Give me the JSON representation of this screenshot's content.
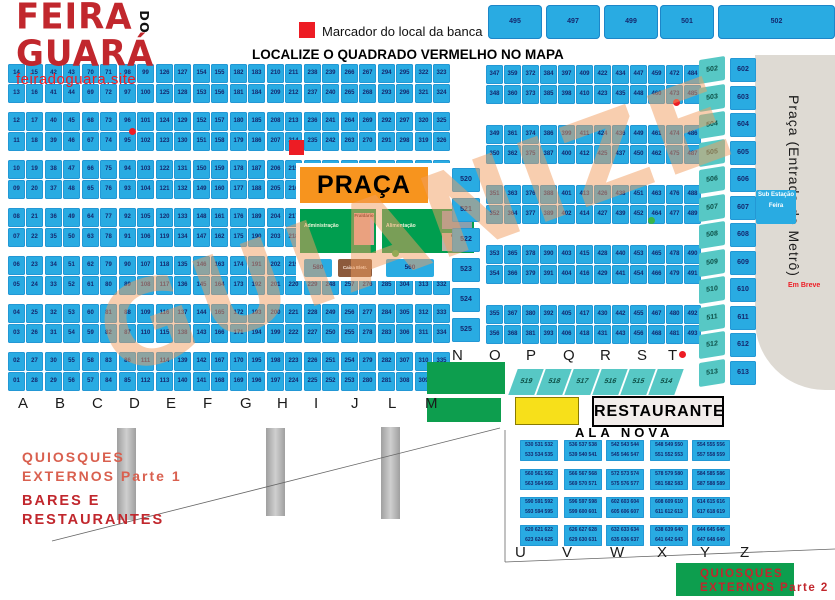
{
  "logo": {
    "line1": "FEIRA",
    "do_text": "DO",
    "line2": "GUARÁ",
    "site": "feiradoguara.site"
  },
  "legend": {
    "marker_label": "Marcador do local da banca",
    "title": "LOCALIZE O QUADRADO VERMELHO NO MAPA"
  },
  "watermark": "GUIANIZE",
  "colors": {
    "stall_blue": "#29ABE2",
    "teal": "#57C8C5",
    "accent_red": "#ED1C24",
    "dark_red": "#C1272D",
    "orange": "#F7941E",
    "green": "#0D9E4E",
    "yellow": "#F7E01A",
    "gray_shape": "#DEDAD3"
  },
  "top_blocks": {
    "squares": [
      495,
      497,
      499,
      501
    ],
    "wide": 502
  },
  "main_grid": {
    "columns": [
      {
        "letter": "A",
        "pairs": [
          [
            14,
            15
          ],
          [
            13,
            16
          ],
          [
            12,
            17
          ],
          [
            11,
            18
          ],
          [
            10,
            19
          ],
          [
            9,
            20
          ],
          [
            8,
            21
          ],
          [
            7,
            22
          ],
          [
            6,
            23
          ],
          [
            5,
            24
          ],
          [
            4,
            25
          ],
          [
            3,
            26
          ],
          [
            2,
            27
          ],
          [
            1,
            28
          ]
        ]
      },
      {
        "letter": "B",
        "pairs": [
          [
            42,
            43
          ],
          [
            41,
            44
          ],
          [
            40,
            45
          ],
          [
            39,
            46
          ],
          [
            38,
            47
          ],
          [
            37,
            48
          ],
          [
            36,
            49
          ],
          [
            35,
            50
          ],
          [
            34,
            51
          ],
          [
            33,
            52
          ],
          [
            32,
            53
          ],
          [
            31,
            54
          ],
          [
            30,
            55
          ],
          [
            29,
            56
          ]
        ]
      },
      {
        "letter": "C",
        "pairs": [
          [
            70,
            71
          ],
          [
            69,
            72
          ],
          [
            68,
            73
          ],
          [
            67,
            74
          ],
          [
            66,
            75
          ],
          [
            65,
            76
          ],
          [
            64,
            77
          ],
          [
            63,
            78
          ],
          [
            62,
            79
          ],
          [
            61,
            80
          ],
          [
            60,
            81
          ],
          [
            59,
            82
          ],
          [
            58,
            83
          ],
          [
            57,
            84
          ]
        ]
      },
      {
        "letter": "D",
        "pairs": [
          [
            98,
            99
          ],
          [
            97,
            100
          ],
          [
            96,
            101
          ],
          [
            95,
            102
          ],
          [
            94,
            103
          ],
          [
            93,
            104
          ],
          [
            92,
            105
          ],
          [
            91,
            106
          ],
          [
            90,
            107
          ],
          [
            89,
            108
          ],
          [
            88,
            109
          ],
          [
            87,
            110
          ],
          [
            86,
            111
          ],
          [
            85,
            112
          ]
        ]
      },
      {
        "letter": "E",
        "pairs": [
          [
            126,
            127
          ],
          [
            125,
            128
          ],
          [
            124,
            129
          ],
          [
            123,
            130
          ],
          [
            122,
            131
          ],
          [
            121,
            132
          ],
          [
            120,
            133
          ],
          [
            119,
            134
          ],
          [
            118,
            135
          ],
          [
            117,
            136
          ],
          [
            116,
            137
          ],
          [
            115,
            138
          ],
          [
            114,
            139
          ],
          [
            113,
            140
          ]
        ]
      },
      {
        "letter": "F",
        "pairs": [
          [
            154,
            155
          ],
          [
            153,
            156
          ],
          [
            152,
            157
          ],
          [
            151,
            158
          ],
          [
            150,
            159
          ],
          [
            149,
            160
          ],
          [
            148,
            161
          ],
          [
            147,
            162
          ],
          [
            146,
            163
          ],
          [
            145,
            164
          ],
          [
            144,
            165
          ],
          [
            143,
            166
          ],
          [
            142,
            167
          ],
          [
            141,
            168
          ]
        ]
      },
      {
        "letter": "G",
        "pairs": [
          [
            182,
            183
          ],
          [
            181,
            184
          ],
          [
            180,
            185
          ],
          [
            179,
            186
          ],
          [
            178,
            187
          ],
          [
            177,
            188
          ],
          [
            176,
            189
          ],
          [
            175,
            190
          ],
          [
            174,
            191
          ],
          [
            173,
            192
          ],
          [
            172,
            193
          ],
          [
            171,
            194
          ],
          [
            170,
            195
          ],
          [
            169,
            196
          ]
        ]
      },
      {
        "letter": "H",
        "pairs": [
          [
            210,
            211
          ],
          [
            209,
            212
          ],
          [
            208,
            213
          ],
          [
            207,
            214
          ],
          [
            206,
            215
          ],
          [
            205,
            216
          ],
          [
            204,
            217
          ],
          [
            203,
            218
          ],
          [
            202,
            219
          ],
          [
            201,
            220
          ],
          [
            200,
            221
          ],
          [
            199,
            222
          ],
          [
            198,
            223
          ],
          [
            197,
            224
          ]
        ]
      },
      {
        "letter": "I",
        "pairs": [
          [
            238,
            239
          ],
          [
            237,
            240
          ],
          [
            236,
            241
          ],
          [
            235,
            242
          ],
          [
            234,
            243
          ],
          [
            233,
            244
          ],
          [
            232,
            245
          ],
          [
            231,
            246
          ],
          [
            230,
            247
          ],
          [
            229,
            248
          ],
          [
            228,
            249
          ],
          [
            227,
            250
          ],
          [
            226,
            251
          ],
          [
            225,
            252
          ]
        ]
      },
      {
        "letter": "J",
        "pairs": [
          [
            266,
            267
          ],
          [
            265,
            268
          ],
          [
            264,
            269
          ],
          [
            263,
            270
          ],
          [
            262,
            271
          ],
          [
            261,
            272
          ],
          [
            260,
            273
          ],
          [
            259,
            274
          ],
          [
            258,
            275
          ],
          [
            257,
            276
          ],
          [
            256,
            277
          ],
          [
            255,
            278
          ],
          [
            254,
            279
          ],
          [
            253,
            280
          ]
        ]
      },
      {
        "letter": "L",
        "pairs": [
          [
            294,
            295
          ],
          [
            293,
            296
          ],
          [
            292,
            297
          ],
          [
            291,
            298
          ],
          [
            290,
            299
          ],
          [
            289,
            300
          ],
          [
            288,
            301
          ],
          [
            287,
            302
          ],
          [
            286,
            303
          ],
          [
            285,
            304
          ],
          [
            284,
            305
          ],
          [
            283,
            306
          ],
          [
            282,
            307
          ],
          [
            281,
            308
          ]
        ]
      },
      {
        "letter": "M",
        "pairs": [
          [
            322,
            323
          ],
          [
            321,
            324
          ],
          [
            320,
            325
          ],
          [
            319,
            326
          ],
          [
            318,
            327
          ],
          [
            317,
            328
          ],
          [
            316,
            329
          ],
          [
            315,
            330
          ],
          [
            314,
            331
          ],
          [
            313,
            332
          ],
          [
            312,
            333
          ],
          [
            311,
            334
          ],
          [
            310,
            335
          ],
          [
            309,
            336
          ]
        ]
      }
    ]
  },
  "right_grid": {
    "letters": [
      "N",
      "O",
      "P",
      "Q",
      "R",
      "S",
      "T"
    ],
    "columns": [
      {
        "pairs": [
          [
            347,
            359
          ],
          [
            348,
            360
          ],
          [
            349,
            361
          ],
          [
            350,
            362
          ],
          [
            351,
            363
          ],
          [
            352,
            364
          ],
          [
            353,
            365
          ],
          [
            354,
            366
          ],
          [
            355,
            367
          ],
          [
            356,
            368
          ]
        ]
      },
      {
        "pairs": [
          [
            372,
            384
          ],
          [
            373,
            385
          ],
          [
            374,
            386
          ],
          [
            375,
            387
          ],
          [
            376,
            388
          ],
          [
            377,
            389
          ],
          [
            378,
            390
          ],
          [
            379,
            391
          ],
          [
            380,
            392
          ],
          [
            381,
            393
          ]
        ]
      },
      {
        "pairs": [
          [
            397,
            409
          ],
          [
            398,
            410
          ],
          [
            399,
            411
          ],
          [
            400,
            412
          ],
          [
            401,
            413
          ],
          [
            402,
            414
          ],
          [
            403,
            415
          ],
          [
            404,
            416
          ],
          [
            405,
            417
          ],
          [
            406,
            418
          ]
        ]
      },
      {
        "pairs": [
          [
            422,
            434
          ],
          [
            423,
            435
          ],
          [
            424,
            436
          ],
          [
            425,
            437
          ],
          [
            426,
            438
          ],
          [
            427,
            439
          ],
          [
            428,
            440
          ],
          [
            429,
            441
          ],
          [
            430,
            442
          ],
          [
            431,
            443
          ]
        ]
      },
      {
        "pairs": [
          [
            447,
            459
          ],
          [
            448,
            460
          ],
          [
            449,
            461
          ],
          [
            450,
            462
          ],
          [
            451,
            463
          ],
          [
            452,
            464
          ],
          [
            453,
            465
          ],
          [
            454,
            466
          ],
          [
            455,
            467
          ],
          [
            456,
            468
          ]
        ]
      },
      {
        "pairs": [
          [
            472,
            484
          ],
          [
            473,
            485
          ],
          [
            474,
            486
          ],
          [
            475,
            487
          ],
          [
            476,
            488
          ],
          [
            477,
            489
          ],
          [
            478,
            490
          ],
          [
            479,
            491
          ],
          [
            480,
            492
          ],
          [
            481,
            493
          ]
        ]
      }
    ]
  },
  "teal_row": [
    519,
    518,
    517,
    516,
    515,
    514
  ],
  "side_columns": {
    "outer": [
      502,
      503,
      504,
      505,
      506,
      507,
      508,
      509,
      510,
      511,
      512,
      513
    ],
    "inner": [
      602,
      603,
      604,
      605,
      606,
      607,
      608,
      609,
      610,
      611,
      612,
      613
    ],
    "substation": "Sub Estação Feira",
    "coming_soon": "Em Breve",
    "metro_label": "Praça (Entrada do Metrô)"
  },
  "praca": {
    "title": "PRAÇA",
    "area1": "Administração",
    "area1_sub": "Fraldário",
    "area2": "Alimentação",
    "area2_sub1": "Som",
    "area2_sub2": "Caixa",
    "box_a": "580",
    "box_b": "Caixa Eletr.",
    "box_c": "560",
    "stack": [
      520,
      521,
      522,
      523,
      524,
      525
    ]
  },
  "restaurante": "RESTAURANTE",
  "ala_nova": {
    "title": "ALA NOVA",
    "letters": [
      "U",
      "V",
      "W",
      "X",
      "Y",
      "Z"
    ],
    "blocks": [
      [
        530,
        531,
        532,
        533,
        534,
        535
      ],
      [
        536,
        537,
        538,
        539,
        540,
        541
      ],
      [
        542,
        543,
        544,
        545,
        546,
        547
      ],
      [
        548,
        549,
        550,
        551,
        552,
        553
      ],
      [
        554,
        555,
        556,
        557,
        558,
        559
      ],
      [
        560,
        561,
        562,
        563,
        564,
        565
      ],
      [
        566,
        567,
        568,
        569,
        570,
        571
      ],
      [
        572,
        573,
        574,
        575,
        576,
        577
      ],
      [
        578,
        579,
        580,
        581,
        582,
        583
      ],
      [
        584,
        585,
        586,
        587,
        588,
        589
      ],
      [
        590,
        591,
        592,
        593,
        594,
        595
      ],
      [
        596,
        597,
        598,
        599,
        600,
        601
      ],
      [
        602,
        603,
        604,
        605,
        606,
        607
      ],
      [
        608,
        609,
        610,
        611,
        612,
        613
      ],
      [
        614,
        615,
        616,
        617,
        618,
        619
      ],
      [
        620,
        621,
        622,
        623,
        624,
        625
      ],
      [
        626,
        627,
        628,
        629,
        630,
        631
      ],
      [
        632,
        633,
        634,
        635,
        636,
        637
      ],
      [
        638,
        639,
        640,
        641,
        642,
        643
      ],
      [
        644,
        645,
        646,
        647,
        648,
        649
      ]
    ]
  },
  "labels": {
    "quiosques1_l1": "QUIOSQUES",
    "quiosques1_l2": "EXTERNOS Parte 1",
    "bares_l1": "BARES E",
    "bares_l2": "RESTAURANTES",
    "quiosques2_l1": "QUIOSQUES",
    "quiosques2_l2": "EXTERNOS Parte 2"
  }
}
